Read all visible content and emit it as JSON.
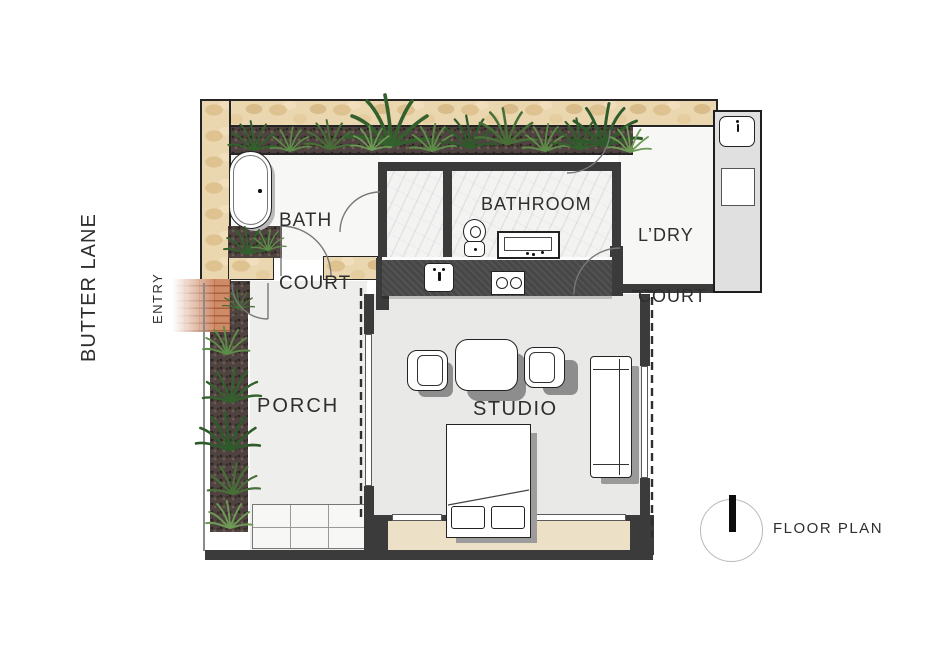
{
  "labels": {
    "street": "BUTTER LANE",
    "entry": "ENTRY",
    "bath_court_line1": "BATH",
    "bath_court_line2": "COURT",
    "bathroom": "BATHROOM",
    "laundry_line1": "L’DRY",
    "laundry_line2": "COURT",
    "porch": "PORCH",
    "studio": "STUDIO",
    "floor_plan": "FLOOR PLAN"
  },
  "icons": [
    "bathtub-icon",
    "toilet-icon",
    "vanity-sink-icon",
    "kitchen-sink-icon",
    "cooktop-icon",
    "laundry-sink-icon",
    "washer-icon",
    "dining-table-icon",
    "chair-icon",
    "sofa-icon",
    "bed-icon",
    "fern-plant-icon",
    "north-arrow-icon",
    "door-swing-arc",
    "roofline-dashed"
  ],
  "colors": {
    "wall": "#3b3b3b",
    "stone": "#ead7b0",
    "brick": "#cf8a67",
    "mulch": "#4e4340",
    "plant_dark": "#33602c",
    "plant_light": "#5d8c48",
    "floor_interior": "#e9e9e7",
    "floor_court": "#f7f7f5",
    "deck": "#ece1c6",
    "shadow": "#8d8d8d",
    "text": "#2e2e2e"
  }
}
